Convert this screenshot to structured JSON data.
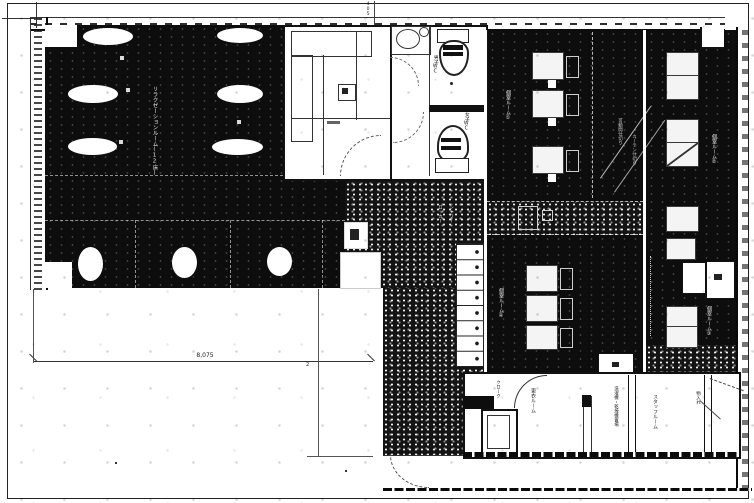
{
  "document": {
    "type": "scanned architectural floor plan",
    "style": "black-and-white dithered blueprint scan"
  },
  "colors": {
    "ink": "#111111",
    "paper": "#ffffff",
    "room_fill": "#0d0d0d",
    "corridor_fill": "#141414"
  },
  "labels": {
    "main_room": "リラクゼーションルーム(12床)",
    "wc_upper": "男子WC",
    "wc_lower": "女子WC",
    "room_f": "個室ルーム①",
    "room_g_upper": "個室ルーム②",
    "room_g_lower": "個室ルーム③",
    "room_h": "個室ルーム④",
    "note_diag_1": "可動間仕切り",
    "note_diag_2": "カーテン仕切り",
    "locker": "ロッカー",
    "shower": "シャワー",
    "closet": "クローク",
    "changing": "更衣ルーム",
    "laundry": "洗濯機・乾燥機置場",
    "staff": "スタッフルーム",
    "storage": "物入れ"
  },
  "dimensions": {
    "bottom_width": "8,075",
    "top_offset": "405",
    "side_mark": "2"
  },
  "fixtures": {
    "oval_tables": 6,
    "round_stools": 3,
    "beds_room_f": 3,
    "beds_room_g": 8,
    "beds_room_h": 3,
    "lockers": 8,
    "toilets": 2,
    "sinks": 1
  }
}
